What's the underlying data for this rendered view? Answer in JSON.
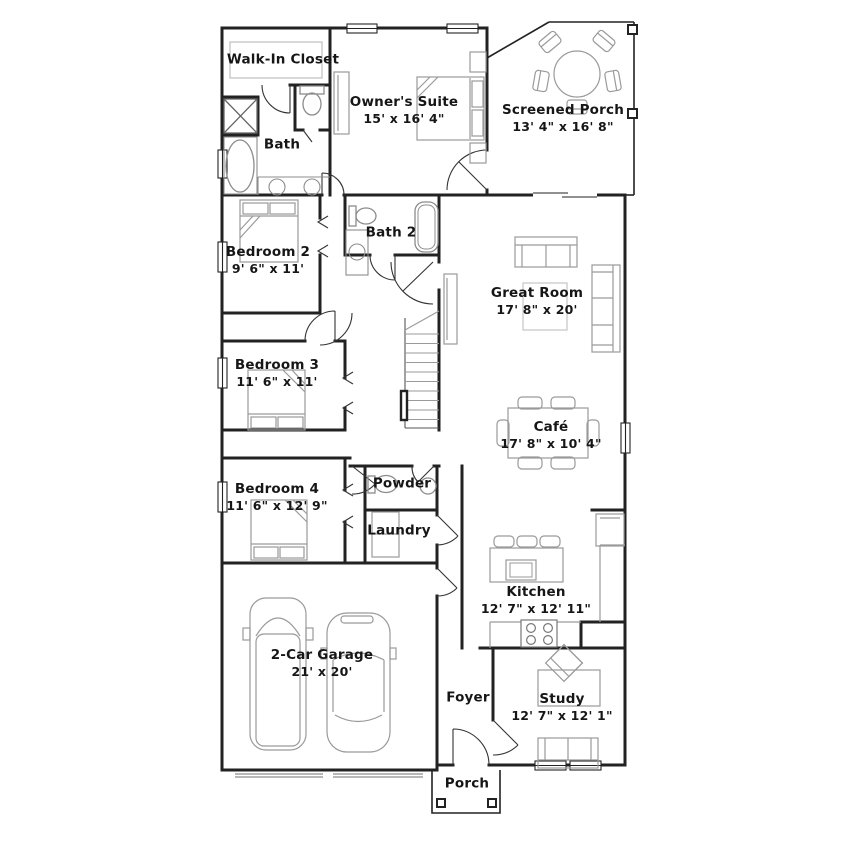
{
  "title": "Floor plan",
  "colors": {
    "wall": "#222222",
    "furniture": "#9a9a9a",
    "fixture": "#8c8c8c",
    "text": "#161616",
    "background": "#ffffff"
  },
  "rooms": {
    "walk_in_closet": {
      "name": "Walk-In Closet"
    },
    "bath": {
      "name": "Bath"
    },
    "owners_suite": {
      "name": "Owner's Suite",
      "dims": "15' x 16' 4\""
    },
    "screened_porch": {
      "name": "Screened Porch",
      "dims": "13' 4\" x 16' 8\""
    },
    "bedroom2": {
      "name": "Bedroom 2",
      "dims": "9' 6\" x 11'"
    },
    "bath2": {
      "name": "Bath 2"
    },
    "great_room": {
      "name": "Great Room",
      "dims": "17' 8\" x 20'"
    },
    "bedroom3": {
      "name": "Bedroom 3",
      "dims": "11' 6\" x 11'"
    },
    "cafe": {
      "name": "Café",
      "dims": "17' 8\" x 10' 4\""
    },
    "bedroom4": {
      "name": "Bedroom 4",
      "dims": "11' 6\" x 12' 9\""
    },
    "powder": {
      "name": "Powder"
    },
    "laundry": {
      "name": "Laundry"
    },
    "kitchen": {
      "name": "Kitchen",
      "dims": "12' 7\" x 12' 11\""
    },
    "garage": {
      "name": "2-Car Garage",
      "dims": "21' x 20'"
    },
    "foyer": {
      "name": "Foyer"
    },
    "study": {
      "name": "Study",
      "dims": "12' 7\" x 12' 1\""
    },
    "porch": {
      "name": "Porch"
    }
  }
}
